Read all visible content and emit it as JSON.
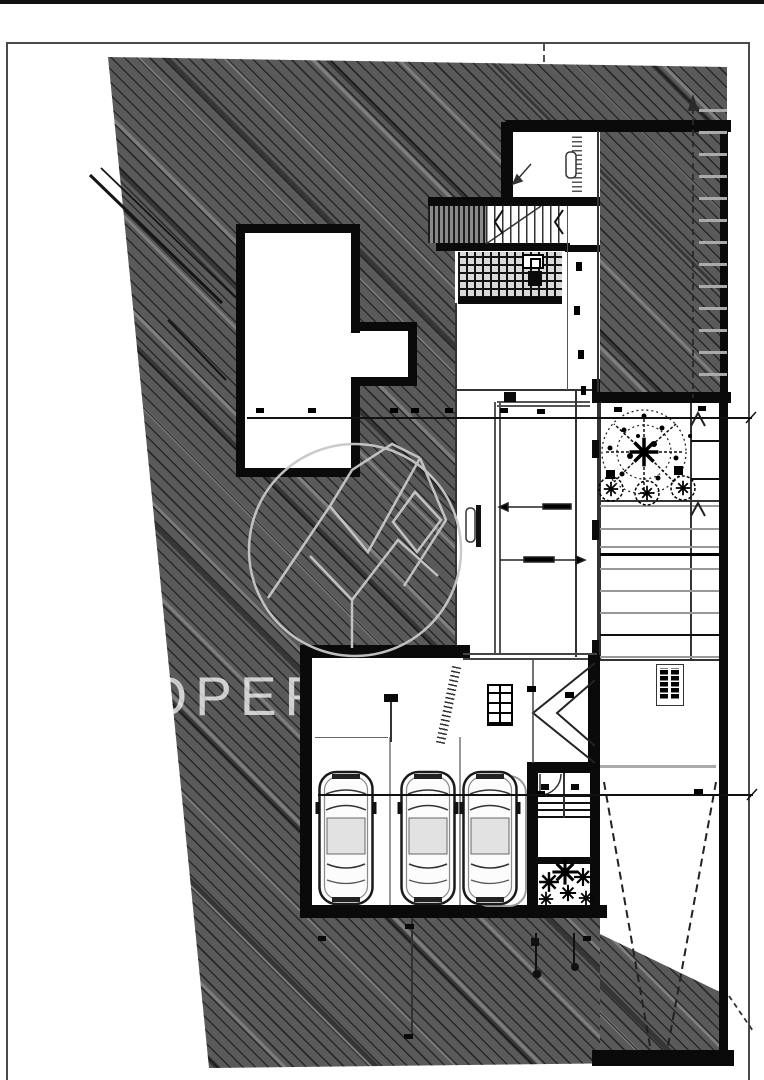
{
  "watermark": {
    "text": "PROPERTY",
    "logo": "circular-geometric-mountain-logo"
  },
  "plan": {
    "type": "architectural-site-and-basement-floor-plan",
    "regions": [
      "site-hatch",
      "entry-room",
      "main-staircase",
      "floor-grate",
      "glazed-corridor",
      "t-shaped-room",
      "garage",
      "vestibule-stair",
      "planting-bed-trees",
      "exterior-steps",
      "ramp-with-slope-arrows",
      "hatched-driveway-wedge"
    ],
    "garage": {
      "car_count": 3,
      "door_panel_chevrons": 2,
      "parking_dividers": 2
    },
    "section_lines": 2,
    "trees": {
      "large": 1,
      "bushes": 3
    }
  },
  "colors": {
    "paper": "#ffffff",
    "wall_ink": "#0a0a0a",
    "hatch_base": "#5a5a5a",
    "line": "#222222",
    "gray_line": "#999999",
    "watermark_text": "rgba(255,255,255,0.72)",
    "watermark_logo": "#c8c8c8"
  }
}
